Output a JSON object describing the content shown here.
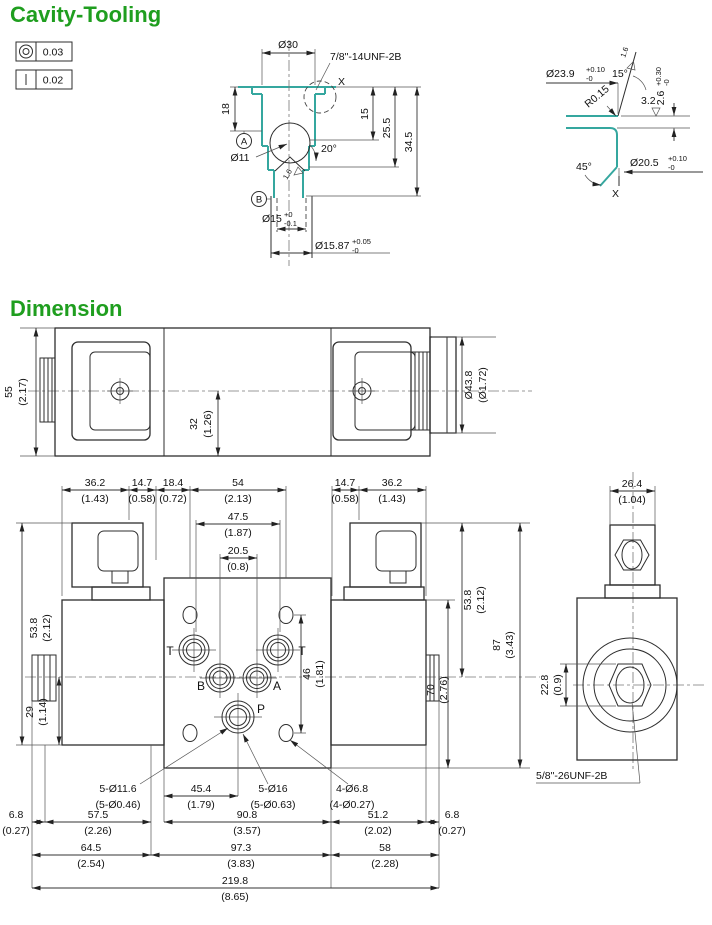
{
  "titles": {
    "cavity_tooling": "Cavity-Tooling",
    "dimension": "Dimension"
  },
  "colors": {
    "title_green": "#1f9e1f",
    "tool_teal": "#35a79f",
    "line_dark": "#2e2e2e"
  },
  "gdt": {
    "concentricity_tol": "0.03",
    "straightness_tol": "0.02"
  },
  "cavity": {
    "dia30": "Ø30",
    "thread_spec": "7/8\"-14UNF-2B",
    "detail_ref": "X",
    "depth18": "18",
    "depth15": "15",
    "depth25_5": "25.5",
    "depth34_5": "34.5",
    "datum_a": "A",
    "datum_b": "B",
    "dia11": "Ø11",
    "angle20": "20°",
    "finish1_6": "1.6",
    "dia15": {
      "v": "Ø15",
      "up": "+0",
      "lo": "-0.1"
    },
    "dia15_87": {
      "v": "Ø15.87",
      "up": "+0.05",
      "lo": "-0"
    }
  },
  "detail_x": {
    "dia23_9": {
      "v": "Ø23.9",
      "up": "+0.10",
      "lo": "-0"
    },
    "finish1_6": "1.6",
    "angle15": "15°",
    "radius": "R0.15",
    "finish3_2": "3.2",
    "depth2_6": {
      "v": "2.6",
      "up": "+0.30",
      "lo": "-0"
    },
    "angle45": "45°",
    "dia20_5": {
      "v": "Ø20.5",
      "up": "+0.10",
      "lo": "-0"
    },
    "label": "X"
  },
  "top_view": {
    "h55": {
      "mm": "55",
      "in": "(2.17)"
    },
    "h32": {
      "mm": "32",
      "in": "(1.26)"
    },
    "dia43_8": {
      "mm": "Ø43.8",
      "in": "(Ø1.72)"
    }
  },
  "front_view": {
    "top_dims": [
      {
        "mm": "36.2",
        "in": "(1.43)"
      },
      {
        "mm": "14.7",
        "in": "(0.58)"
      },
      {
        "mm": "18.4",
        "in": "(0.72)"
      },
      {
        "mm": "54",
        "in": "(2.13)"
      },
      {
        "mm": "47.5",
        "in": "(1.87)"
      },
      {
        "mm": "20.5",
        "in": "(0.8)"
      },
      {
        "mm": "14.7",
        "in": "(0.58)"
      },
      {
        "mm": "36.2",
        "in": "(1.43)"
      }
    ],
    "left_dims": [
      {
        "mm": "53.8",
        "in": "(2.12)"
      },
      {
        "mm": "29",
        "in": "(1.14)"
      }
    ],
    "right_dims": [
      {
        "mm": "53.8",
        "in": "(2.12)"
      },
      {
        "mm": "87",
        "in": "(3.43)"
      },
      {
        "mm": "70",
        "in": "(2.76)"
      },
      {
        "mm": "46",
        "in": "(1.81)"
      }
    ],
    "ports": {
      "t_left": "T",
      "t_right": "T",
      "b": "B",
      "a": "A",
      "p": "P"
    },
    "callouts": [
      {
        "mm": "5-Ø11.6",
        "in": "(5-Ø0.46)"
      },
      {
        "mm": "45.4",
        "in": "(1.79)"
      },
      {
        "mm": "5-Ø16",
        "in": "(5-Ø0.63)"
      },
      {
        "mm": "4-Ø6.8",
        "in": "(4-Ø0.27)"
      }
    ],
    "bottom_row1": [
      {
        "mm": "6.8",
        "in": "(0.27)"
      },
      {
        "mm": "57.5",
        "in": "(2.26)"
      },
      {
        "mm": "90.8",
        "in": "(3.57)"
      },
      {
        "mm": "51.2",
        "in": "(2.02)"
      },
      {
        "mm": "6.8",
        "in": "(0.27)"
      }
    ],
    "bottom_row2": [
      {
        "mm": "64.5",
        "in": "(2.54)"
      },
      {
        "mm": "97.3",
        "in": "(3.83)"
      },
      {
        "mm": "58",
        "in": "(2.28)"
      }
    ],
    "bottom_row3": [
      {
        "mm": "219.8",
        "in": "(8.65)"
      }
    ]
  },
  "side_view": {
    "w26_4": {
      "mm": "26.4",
      "in": "(1.04)"
    },
    "h22_8": {
      "mm": "22.8",
      "in": "(0.9)"
    },
    "thread_spec": "5/8\"-26UNF-2B"
  }
}
